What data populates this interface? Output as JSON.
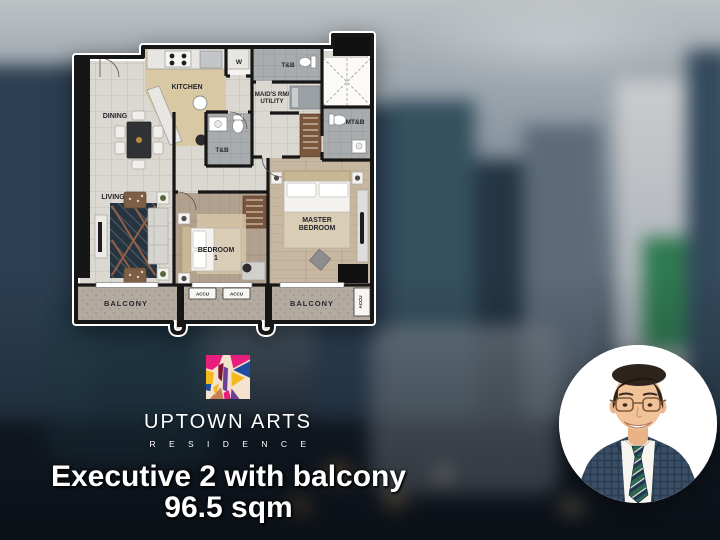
{
  "floorplan": {
    "labels": {
      "kitchen": "KITCHEN",
      "dining": "DINING",
      "living": "LIVING",
      "washer": "W",
      "tb_maid": "T&B",
      "maids_line1": "MAID'S RM/",
      "maids_line2": "UTILITY",
      "mtb": "MT&B",
      "tb_common": "T&B",
      "bedroom1_line1": "BEDROOM",
      "bedroom1_line2": "1",
      "master_line1": "MASTER",
      "master_line2": "BEDROOM",
      "balcony_left": "BALCONY",
      "balcony_right": "BALCONY",
      "accu_1": "ACCU",
      "accu_2": "ACCU",
      "accu_3": "ACCU"
    }
  },
  "brand": {
    "name": "UPTOWN ARTS",
    "residence": "R E S I D E N C E"
  },
  "caption": {
    "title": "Executive 2 with balcony",
    "area": "96.5 sqm"
  },
  "colors": {
    "logo_magenta": "#E81E7E",
    "logo_blue": "#1F4D9F",
    "logo_yellow": "#F5B81C",
    "logo_purple": "#6D3F97",
    "logo_cream": "#F5E2CC",
    "logo_tan": "#C97F54",
    "logo_maroon": "#7C1638"
  }
}
